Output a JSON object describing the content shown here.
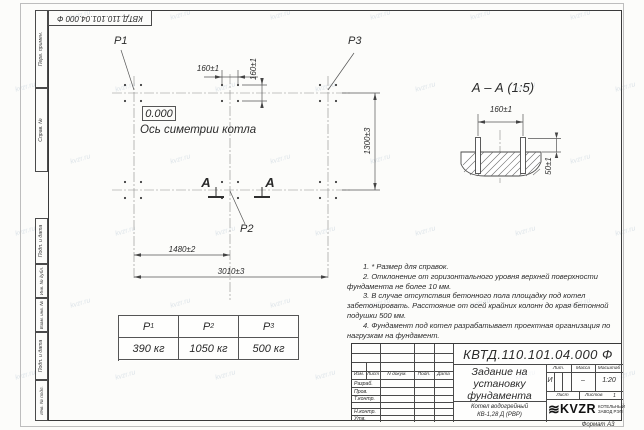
{
  "watermark": {
    "text": "kvzr.ru"
  },
  "top_stamp": {
    "designation": "КВТД.110.101.04.000 Ф"
  },
  "side_strip": {
    "top_cells": [
      "Перв. примен.",
      "Справ. №"
    ],
    "bottom_cells": [
      "Подп. и дата",
      "Инв. № дубл.",
      "Взам. инв. №",
      "Подп. и дата",
      "Инв. № подл."
    ]
  },
  "plan": {
    "p1": "Р1",
    "p2": "Р2",
    "p3": "Р3",
    "level": "0.000",
    "axis_label": "Ось симетрии котла",
    "dim_160_h": "160±1",
    "dim_160_v": "160±1",
    "dim_1300": "1300±3",
    "dim_1480": "1480±2",
    "dim_3010": "3010±3",
    "section_letter_left": "А",
    "section_letter_right": "А"
  },
  "section_view": {
    "title": "А – А (1:5)",
    "dim_160": "160±1",
    "dim_50": "50±1"
  },
  "weights": {
    "headers": [
      {
        "sym": "Р",
        "sub": "1"
      },
      {
        "sym": "Р",
        "sub": "2"
      },
      {
        "sym": "Р",
        "sub": "3"
      }
    ],
    "values": [
      "390 кг",
      "1050 кг",
      "500 кг"
    ]
  },
  "notes": [
    "1. * Размер для справок.",
    "2. Отклонение от горизонтального уровня верхней поверхности фундамента не более 10 мм.",
    "3. В случае отсутствия бетонного пола площадку под котел забетонировать. Расстояние от осей крайних колонн до края бетонной подушки 500 мм.",
    "4. Фундамент под котел разрабатывает проектная организация по нагрузкам на фундамент."
  ],
  "title_block": {
    "designation": "КВТД.110.101.04.000  Ф",
    "header": {
      "izm": "Изм.",
      "list": "Лист",
      "doc": "N докум.",
      "podp": "Подп.",
      "data": "Дата"
    },
    "rows": [
      "Разраб.",
      "Пров.",
      "Т.контр.",
      "",
      "Н.контр.",
      "Утв."
    ],
    "doc_name_lines": [
      "Задание на",
      "установку",
      "фундамента"
    ],
    "lit_label": "Лит.",
    "mass_label": "Масса",
    "scale_label": "Масштаб",
    "lit_value": "И",
    "mass_value": "–",
    "scale_value": "1:20",
    "sheet_label": "Лист",
    "sheets_label": "Листов",
    "sheets_value": "1",
    "product_lines": [
      "Котел водогрейный",
      "КВ-1,28 Д (РВР)"
    ],
    "logo_text": "KVZR",
    "logo_caption_lines": [
      "КОТЕЛЬНЫЙ",
      "ЗАВОД РЭП"
    ],
    "format_note": "Формат А3"
  }
}
